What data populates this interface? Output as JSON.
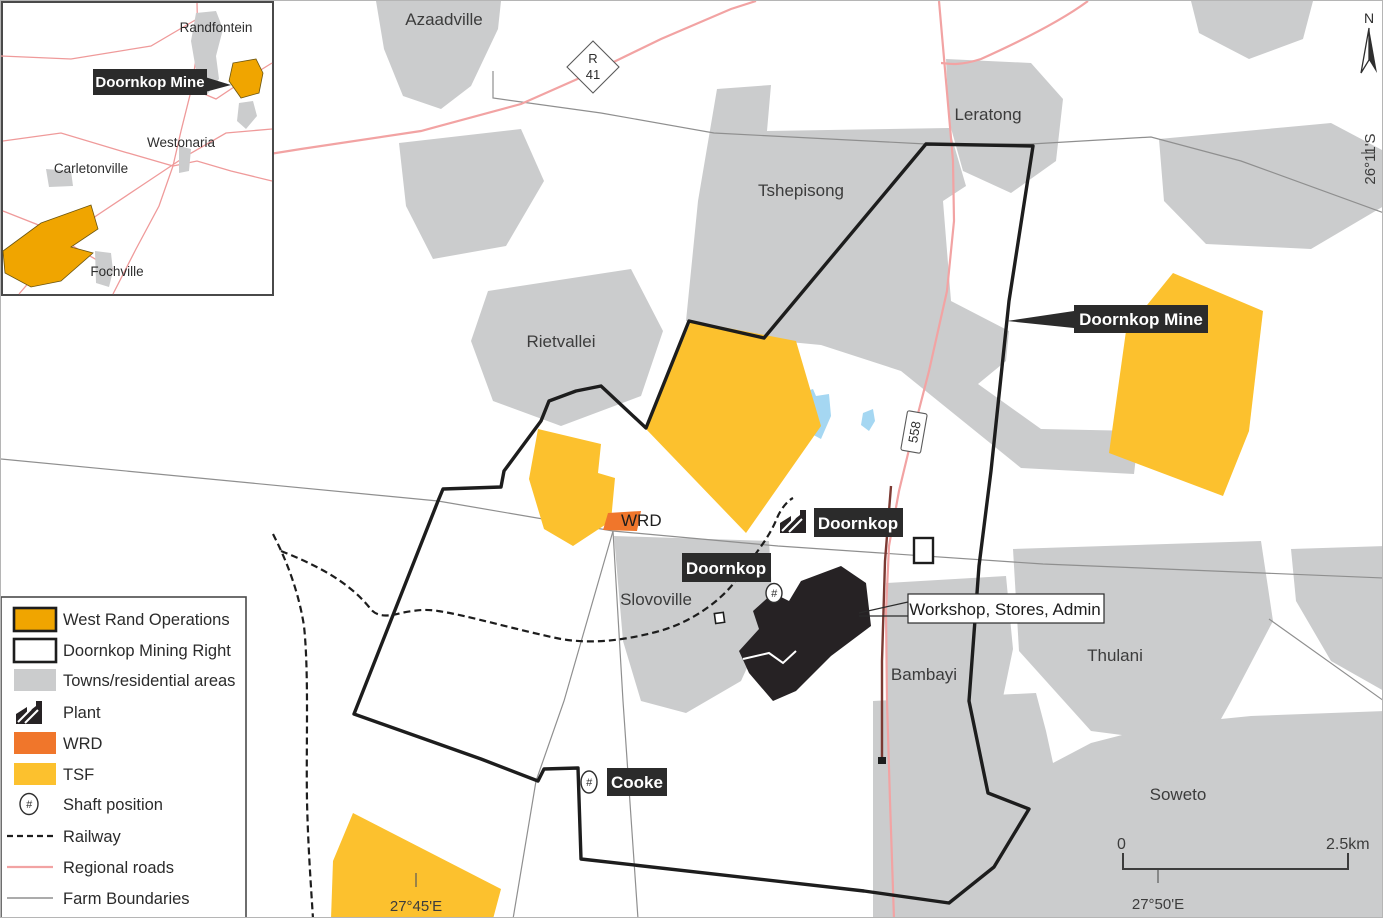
{
  "title": "Doornkop Mine locality map",
  "colors": {
    "west_rand_operations": "#f0a500",
    "tsf": "#fcc12e",
    "wrd": "#f0762b",
    "towns_residential": "#cbcccd",
    "water": "#a5d7f2",
    "regional_road": "#f2a3a3",
    "railway": "#1d1d1d",
    "farm_boundary": "#8f8f8f",
    "mining_right_boundary": "#1d1d1d",
    "label_box_bg": "#2b2b2b"
  },
  "inset": {
    "labels": {
      "randfontein": "Randfontein",
      "westonaria": "Westonaria",
      "carletonville": "Carletonville",
      "fochville": "Fochville",
      "doornkop_mine": "Doornkop Mine"
    }
  },
  "map": {
    "towns": {
      "azaadville": "Azaadville",
      "tshepisong": "Tshepisong",
      "leratong": "Leratong",
      "rietvallei": "Rietvallei",
      "slovoville": "Slovoville",
      "bambayi": "Bambayi",
      "thulani": "Thulani",
      "soweto": "Soweto"
    },
    "callouts": {
      "doornkop_mine": "Doornkop Mine",
      "doornkop_plant": "Doornkop",
      "doornkop_shaft": "Doornkop",
      "cooke": "Cooke",
      "workshop": "Workshop, Stores, Admin"
    },
    "wrd_label": "WRD",
    "shaft_glyph": "#",
    "road_badges": {
      "r41_line1": "R",
      "r41_line2": "41",
      "route_558": "558"
    },
    "graticule": {
      "lat_right": "26°11'S",
      "lon_left": "27°45'E",
      "lon_right": "27°50'E"
    },
    "scale_bar": {
      "start": "0",
      "end": "2.5km"
    },
    "north_label": "N"
  },
  "legend": {
    "items": [
      {
        "key": "west-rand-operations",
        "label": "West Rand Operations"
      },
      {
        "key": "doornkop-mining-right",
        "label": "Doornkop Mining Right"
      },
      {
        "key": "towns-residential",
        "label": "Towns/residential areas"
      },
      {
        "key": "plant",
        "label": "Plant"
      },
      {
        "key": "wrd",
        "label": "WRD"
      },
      {
        "key": "tsf",
        "label": "TSF"
      },
      {
        "key": "shaft-position",
        "label": "Shaft position"
      },
      {
        "key": "railway",
        "label": "Railway"
      },
      {
        "key": "regional-roads",
        "label": "Regional roads"
      },
      {
        "key": "farm-boundaries",
        "label": "Farm Boundaries"
      }
    ]
  }
}
